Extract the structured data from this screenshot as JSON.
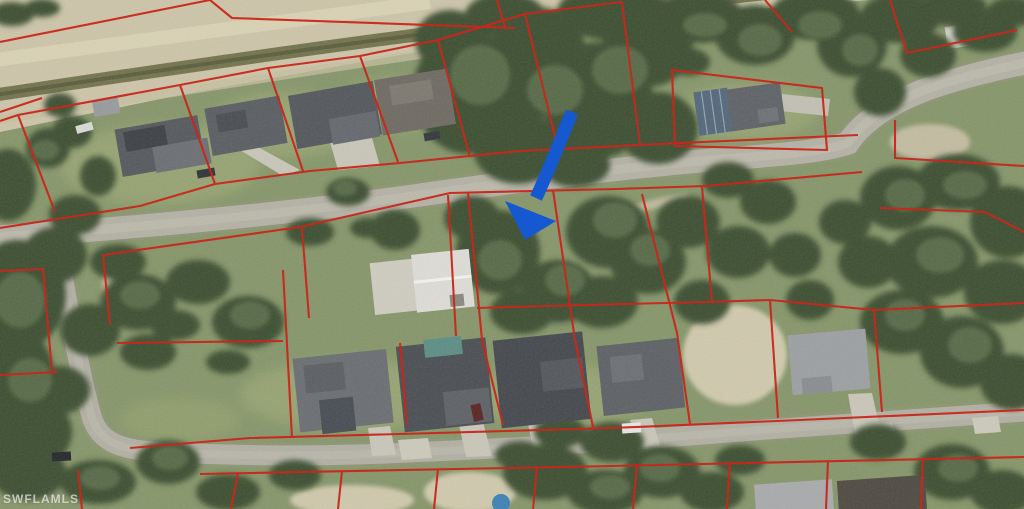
{
  "watermark": {
    "text": "SWFLAMLS",
    "color": "#ffffff"
  },
  "overlay": {
    "parcel_line_color": "#c9271b"
  },
  "annotation": {
    "arrow_color": "#1658cf"
  }
}
